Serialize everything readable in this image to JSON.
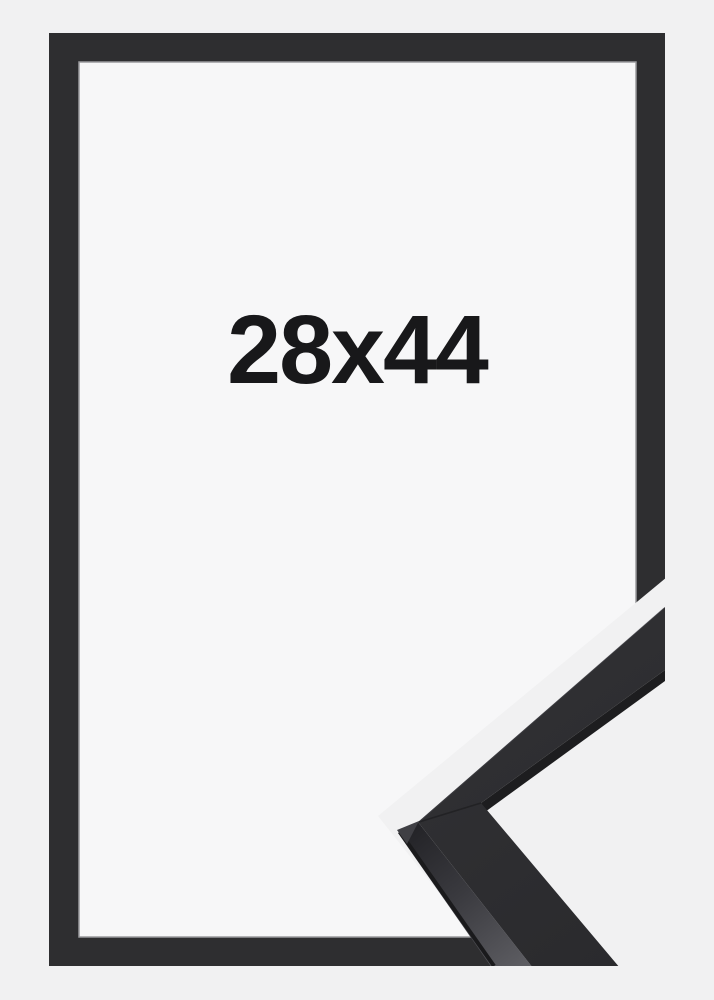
{
  "product": {
    "size_label": "28x44"
  },
  "colors": {
    "background": "#f1f1f2",
    "panel": "#f7f7f8",
    "frame": "#2e2e30",
    "inner_lip": "#9a9a9d",
    "label_text": "#18181a",
    "sample_top_face": "#313134",
    "sample_top_face_shade": "#2a2a2d",
    "sample_edge_strip": "#1d1d1f",
    "sample_side_near": "#232327",
    "sample_side_mid": "#3a3a3f",
    "sample_side_far": "#5f5f64",
    "sample_rim": "#1a1a1c",
    "sample_corner_facet": "#3f3f44",
    "sample_miter_seam": "#1c1c1f",
    "sample_top_highlight": "#4c4c52"
  }
}
